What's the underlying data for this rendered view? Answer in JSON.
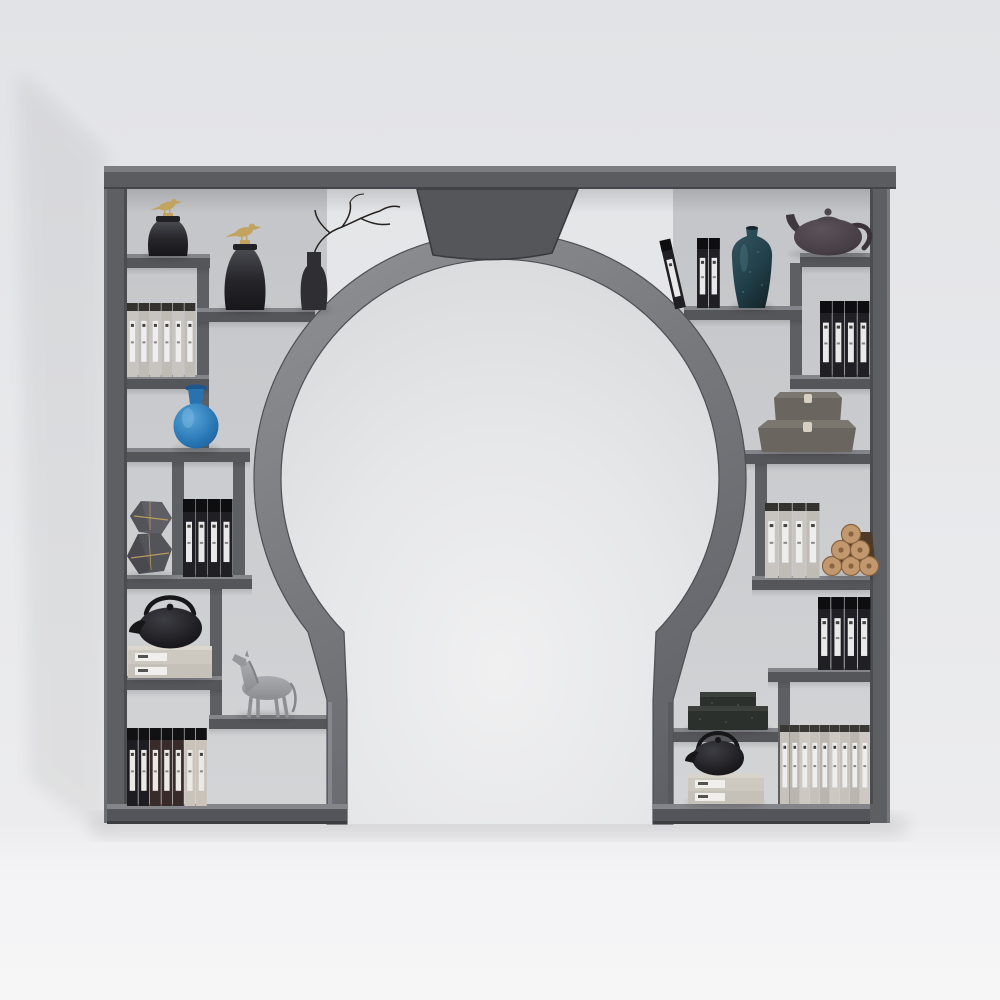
{
  "scene": {
    "description": "3D render of a dark gray moon-gate display shelf with a circular opening, styled with books, vases, teapots and ornaments against a light gray wall",
    "furniture_name": "moon-gate-display-shelf"
  },
  "colors": {
    "wallTop": "#e2e3e6",
    "wallBottom": "#ececee",
    "floor": "#f3f3f5",
    "panel": "#c7c9cc",
    "frame": "#5e5f63",
    "shelfTop": "#84858a",
    "shelfFront": "#55565a",
    "capTop": "#7c7d80",
    "capFront": "#5b5c60",
    "baseTop": "#84858a",
    "baseFront": "#54555a",
    "ringStroke": "#4e4f54",
    "keystone": "#55565a",
    "keystoneStroke": "#393a3e",
    "footLight": "#8f9298",
    "gold": "#c2a35f",
    "glassJar": "#26262b",
    "jarRim": "#222226",
    "branch": "#26221f",
    "bottle": "#2e2e33",
    "blueVase": "#2a7ab8",
    "tealVase": "#22404a",
    "tealSpeckle": "#527c86",
    "ironTeapot": "#1d1d21",
    "ironHandle": "#17171a",
    "clayTeapot": "#453e43",
    "clayHandle": "#3a343a",
    "horse": "#9c9da0",
    "horseLeg": "#8e8f93",
    "hexStone": "#5e5e64",
    "hexStoneDark": "#53535a",
    "box": "#6a665f",
    "boxTop": "#7b776f",
    "boxClasp": "#d7d0c2",
    "log": "#c2996e",
    "logRing": "#8a6340",
    "logBack": "#4e3a29",
    "stone": "#2c302d",
    "stoneTop": "#3b403c",
    "stackBook": "#cdc9c1",
    "stackBook2": "#c5c1b9",
    "stackLabel": "#f0efec",
    "bookBlack": "#1f1f24",
    "shadow": "#000000"
  },
  "book_rows": [
    {
      "name": "classic-books-top-left",
      "x": 127,
      "bottom": 377,
      "height": 74,
      "count": 6,
      "width": 10.8,
      "gap": 0.7,
      "cap_height": 8,
      "cap_color": "#34322f",
      "colors": [
        "#c8c5c0",
        "#bfbcb6",
        "#c8c5c0",
        "#bfbcb6",
        "#c8c5c0",
        "#bfbcb6"
      ],
      "label_color": "#eeeeee"
    },
    {
      "name": "black-folios-mid-left",
      "x": 183,
      "bottom": 577,
      "height": 78,
      "count": 4,
      "width": 12,
      "gap": 0.5,
      "cap_height": 13,
      "cap_color": "#0e0e11",
      "colors": [
        "#1f1f24",
        "#1f1f24",
        "#1f1f24",
        "#1f1f24"
      ],
      "label_color": "#e9e9ea"
    },
    {
      "name": "mixed-books-bottom-left",
      "x": 127,
      "bottom": 806,
      "height": 78,
      "count": 7,
      "width": 10.8,
      "gap": 0.7,
      "cap_height": 12,
      "cap_color": "#111114",
      "colors": [
        "#1d1d21",
        "#1d1d21",
        "#392b2a",
        "#392b2a",
        "#392b2a",
        "#c9c3ba",
        "#c9c3ba"
      ],
      "label_color": "#ebe9e5"
    },
    {
      "name": "black-folios-top-right-upright",
      "x": 697,
      "bottom": 308,
      "height": 70,
      "count": 2,
      "width": 11,
      "gap": 0.8,
      "cap_height": 11,
      "cap_color": "#0e0e11",
      "colors": [
        "#1f1f24",
        "#1f1f24"
      ],
      "label_color": "#e9e9ea"
    },
    {
      "name": "black-folios-right-upper",
      "x": 820,
      "bottom": 377,
      "height": 76,
      "count": 4,
      "width": 11.8,
      "gap": 0.7,
      "cap_height": 12,
      "cap_color": "#0e0e11",
      "colors": [
        "#1f1f24",
        "#1f1f24",
        "#1f1f24",
        "#1f1f24"
      ],
      "label_color": "#e9e9ea"
    },
    {
      "name": "classic-books-right-mid",
      "x": 765,
      "bottom": 578,
      "height": 75,
      "count": 4,
      "width": 13,
      "gap": 0.8,
      "cap_height": 8,
      "cap_color": "#34322f",
      "colors": [
        "#c8c5c0",
        "#bfbcb6",
        "#c8c5c0",
        "#bfbcb6"
      ],
      "label_color": "#eeeeee"
    },
    {
      "name": "black-folios-right-lower",
      "x": 818,
      "bottom": 670,
      "height": 73,
      "count": 4,
      "width": 12.5,
      "gap": 0.8,
      "cap_height": 12,
      "cap_color": "#0e0e11",
      "colors": [
        "#1f1f24",
        "#1f1f24",
        "#1f1f24",
        "#1f1f24"
      ],
      "label_color": "#e9e9ea"
    },
    {
      "name": "classic-books-bottom-right",
      "x": 780,
      "bottom": 804,
      "height": 79,
      "count": 9,
      "width": 9.6,
      "gap": 0.4,
      "cap_height": 7,
      "cap_color": "#3a3834",
      "colors": [
        "#c6c2bb",
        "#bab6af",
        "#cdc9c2",
        "#c6c2bb",
        "#bab6af",
        "#cdc9c2",
        "#c6c2bb",
        "#bab6af",
        "#cdc9c2"
      ],
      "label_color": "#eeeeee"
    }
  ],
  "items": [
    {
      "name": "bird-lid-jar-small",
      "location": "upper-left shelf",
      "color": "#26262b"
    },
    {
      "name": "bird-lid-jar-large",
      "location": "upper-left shelf 2",
      "color": "#26262b"
    },
    {
      "name": "dry-branch-vase",
      "location": "upper-left shelf 2",
      "color": "#2e2e33"
    },
    {
      "name": "blue-glass-vase",
      "location": "left mid shelf",
      "color": "#2a7ab8"
    },
    {
      "name": "hexagon-stone-sculpture",
      "location": "left middle shelf",
      "color": "#5e5e64"
    },
    {
      "name": "iron-teapot-on-books-left",
      "location": "left lower shelf",
      "color": "#1d1d21"
    },
    {
      "name": "horse-figurine",
      "location": "left step shelf",
      "color": "#9c9da0"
    },
    {
      "name": "leaning-black-folio",
      "location": "upper-right shelf",
      "color": "#1f1f24"
    },
    {
      "name": "teal-meiping-vase",
      "location": "upper-right shelf",
      "color": "#22404a"
    },
    {
      "name": "clay-teapot",
      "location": "upper-right raised shelf",
      "color": "#453e43"
    },
    {
      "name": "stacked-storage-boxes",
      "location": "right mid shelf",
      "color": "#6a665f"
    },
    {
      "name": "log-bundle",
      "location": "right middle shelf",
      "color": "#c2996e"
    },
    {
      "name": "stone-slab-stack",
      "location": "lower-right shelf",
      "color": "#2c302d"
    },
    {
      "name": "iron-teapot-on-books-right",
      "location": "lower-right shelf",
      "color": "#1d1d21"
    }
  ]
}
